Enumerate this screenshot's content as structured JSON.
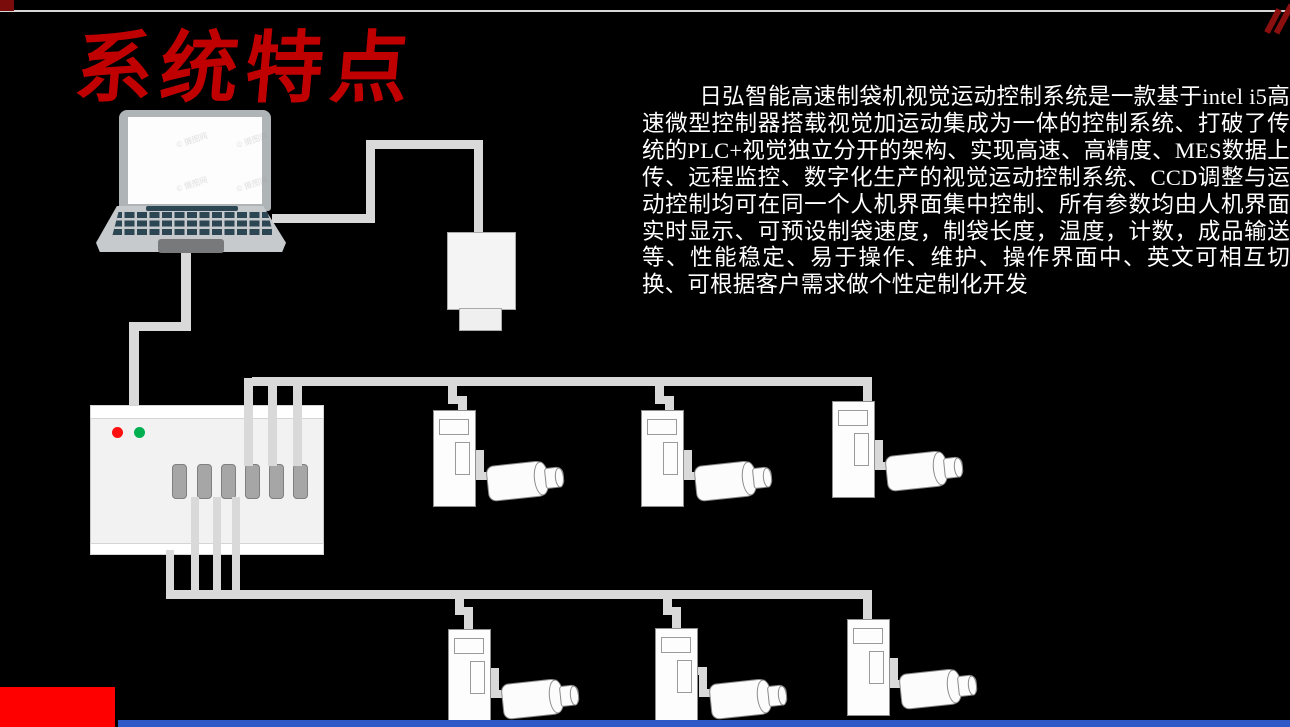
{
  "slide": {
    "title": "系统特点",
    "background": "#000000"
  },
  "description": {
    "text": "日弘智能高速制袋机视觉运动控制系统是一款基于intel i5高速微型控制器搭载视觉加运动集成为一体的控制系统、打破了传统的PLC+视觉独立分开的架构、实现高速、高精度、MES数据上传、远程监控、数字化生产的视觉运动控制系统、CCD调整与运动控制均可在同一个人机界面集中控制、所有参数均由人机界面实时显示、可预设制袋速度，制袋长度，温度，计数，成品输送等、性能稳定、易于操作、维护、操作界面中、英文可相互切换、可根据客户需求做个性定制化开发"
  },
  "watermark": "© 摄图网",
  "colors": {
    "title_red": "#C00000",
    "corner_red": "#7A0C0C",
    "footer_red": "#FF0000",
    "footer_blue": "#2E5AC8",
    "led_red": "#FF1010",
    "led_green": "#00B050",
    "cable_gray": "#D9D9D9",
    "device_fill": "#FDFDFD",
    "device_border": "#8F8F8F",
    "top_hairline": "#D8D8D8"
  },
  "diagram": {
    "laptop_count": 1,
    "ccd_camera_count": 1,
    "motion_controller": {
      "status_leds": [
        "red",
        "green"
      ],
      "output_ports": 6
    },
    "servo_drive_count": 6,
    "servo_motor_count": 6,
    "bus_rows": 2
  }
}
